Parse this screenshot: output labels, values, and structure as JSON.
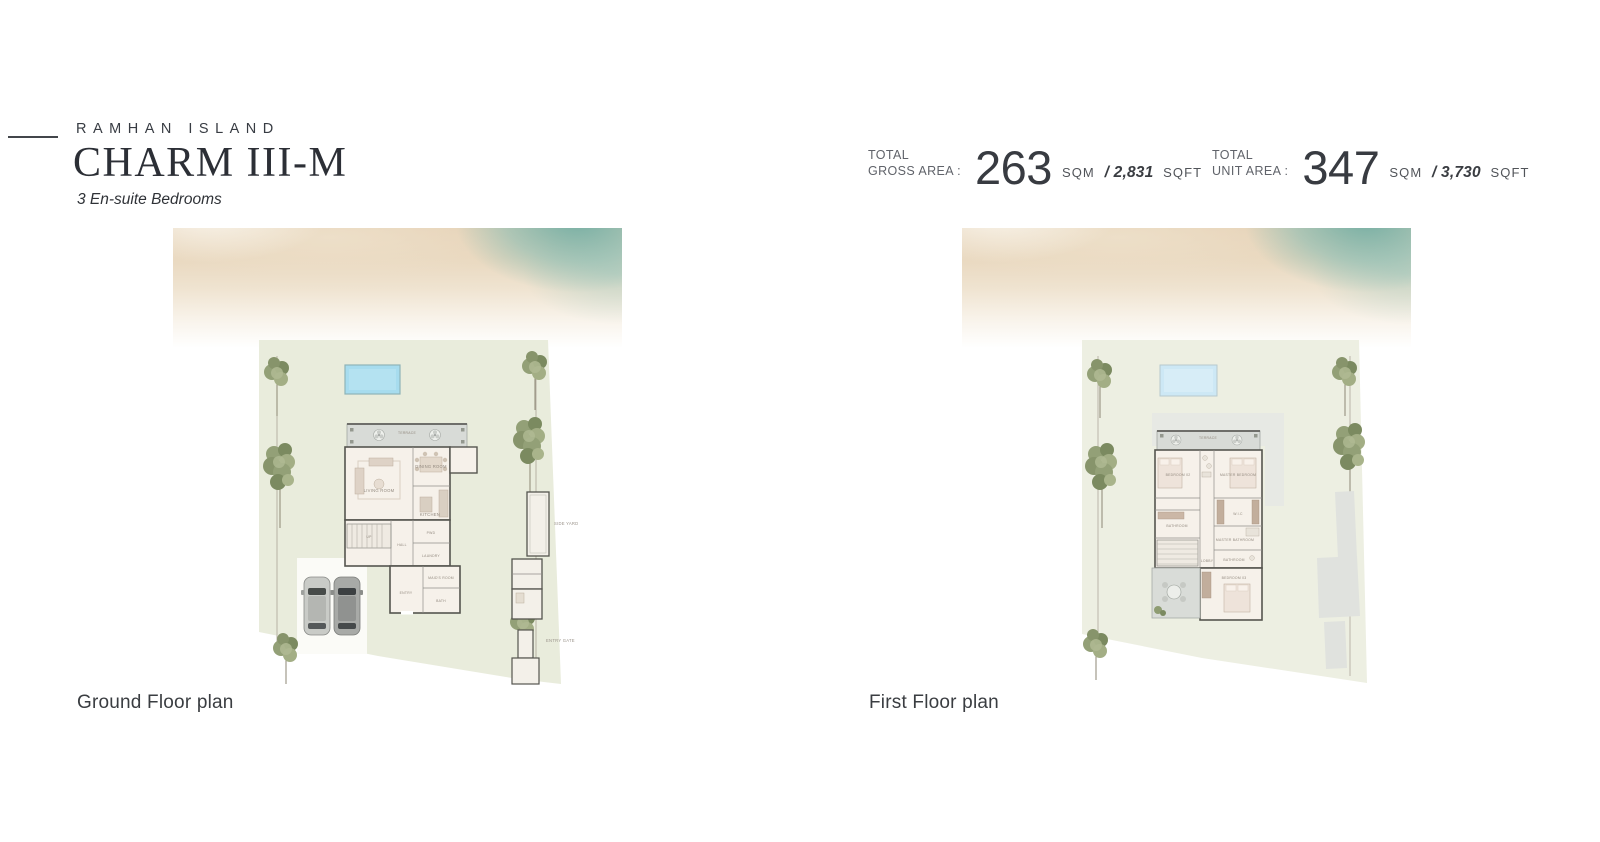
{
  "header": {
    "brand": "RAMHAN ISLAND",
    "title": "CHARM III-M",
    "subtitle": "3 En-suite Bedrooms"
  },
  "stats": {
    "items": [
      {
        "label_line1": "TOTAL",
        "label_line2": "GROSS AREA :",
        "value": "263",
        "sqm_unit": "SQM",
        "slash": "/",
        "sqft_value": "2,831",
        "sqft_unit": "SQFT"
      },
      {
        "label_line1": "TOTAL",
        "label_line2": "UNIT AREA :",
        "value": "347",
        "sqm_unit": "SQM",
        "slash": "/",
        "sqft_value": "3,730",
        "sqft_unit": "SQFT"
      }
    ]
  },
  "plans": [
    {
      "caption": "Ground Floor plan",
      "rooms": {
        "terrace": "TERRACE",
        "living": "LIVING ROOM",
        "dining": "DINING ROOM",
        "kitchen": "KITCHEN",
        "stairs": "UP",
        "hall": "HALL",
        "powder": "PWD",
        "laundry": "LAUNDRY",
        "maid": "MAID'S ROOM",
        "bath": "BATH",
        "entry": "ENTRY",
        "side_yard": "SIDE YARD",
        "gate": "ENTRY GATE"
      }
    },
    {
      "caption": "First Floor plan",
      "rooms": {
        "terrace": "TERRACE",
        "bedroom2": "BEDROOM 02",
        "master": "MASTER BEDROOM",
        "bathroom": "BATHROOM",
        "wic": "W.I.C",
        "master_bath": "MASTER BATHROOM",
        "bath2": "BATHROOM",
        "lobby": "LOBBY",
        "bedroom3": "BEDROOM 03"
      }
    }
  ],
  "colors": {
    "accent_teal": "#7db8b0",
    "sand": "#e8d4ba",
    "plot_green": "#e9ecdc",
    "pool_blue": "#a7dcee",
    "wall_dark": "#55554f",
    "terrace_gray": "#d8dbd7",
    "text_dark": "#34373d"
  }
}
